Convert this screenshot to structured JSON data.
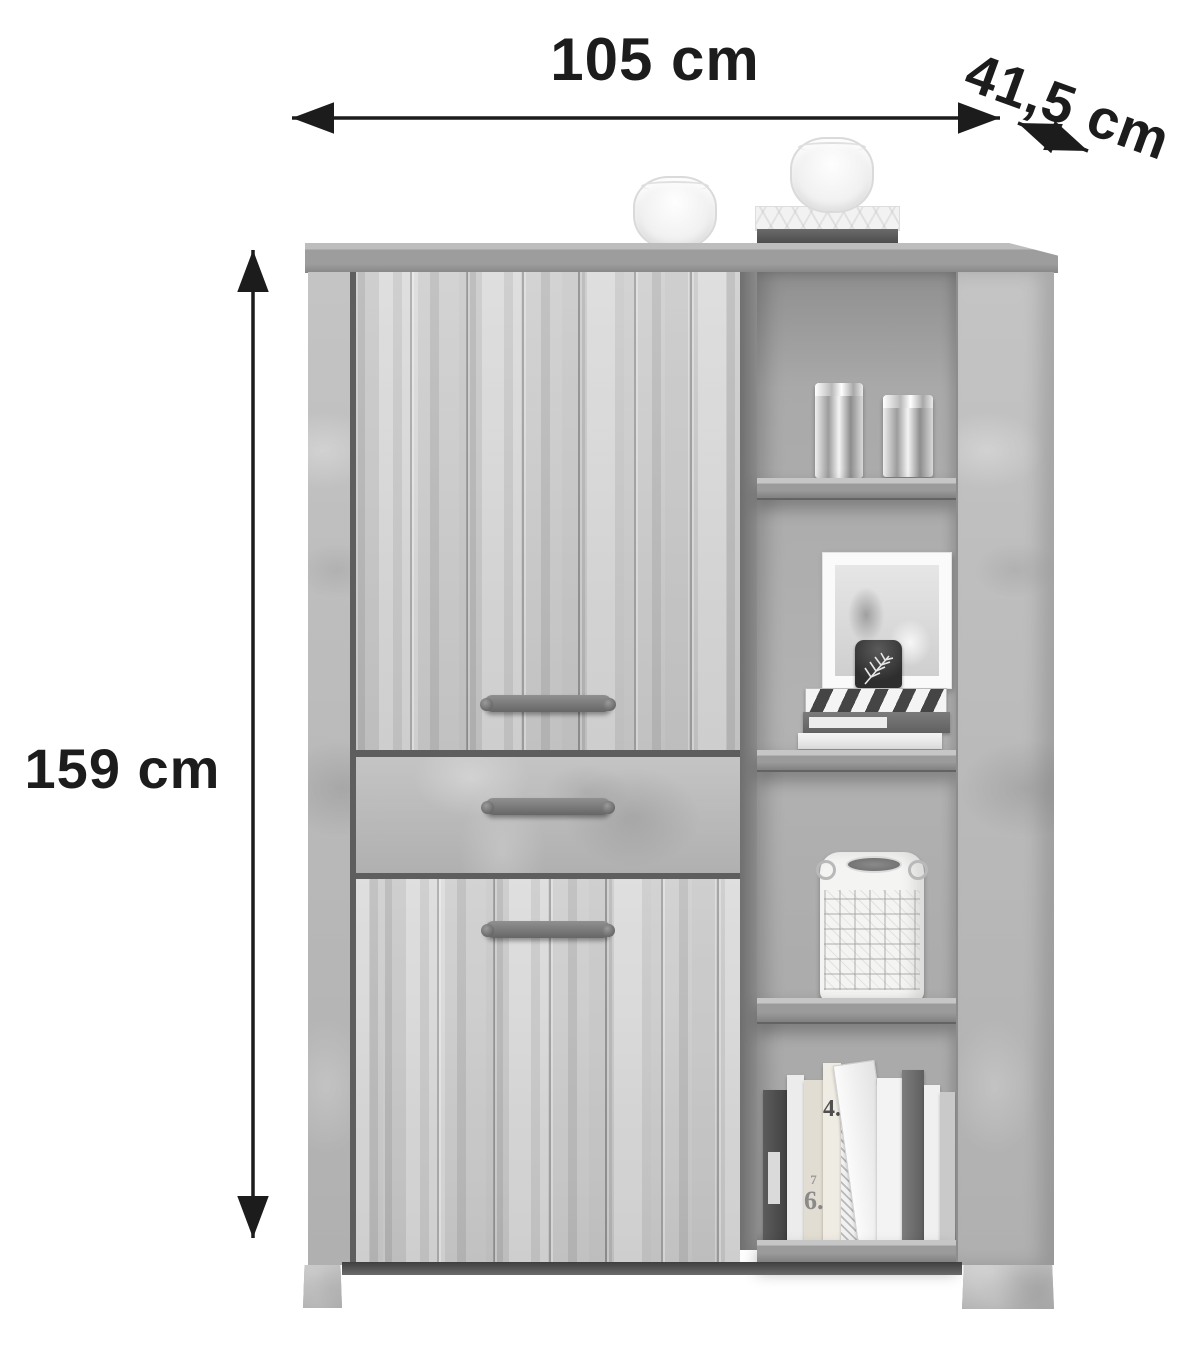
{
  "annotations": {
    "width_label": "105 cm",
    "depth_label": "41,5 cm",
    "height_label": "159 cm"
  },
  "shelf_decor": {
    "book_label_4": "4.",
    "book_label_7": "7",
    "book_label_6": "6."
  },
  "colors": {
    "annotation_ink": "#1c1c1c",
    "background": "#ffffff",
    "wood_gray": "#cdcdcd",
    "concrete_gray": "#bcbcbc",
    "shelf_back_gray": "#a8a8a8",
    "handle_gray": "#707070"
  }
}
